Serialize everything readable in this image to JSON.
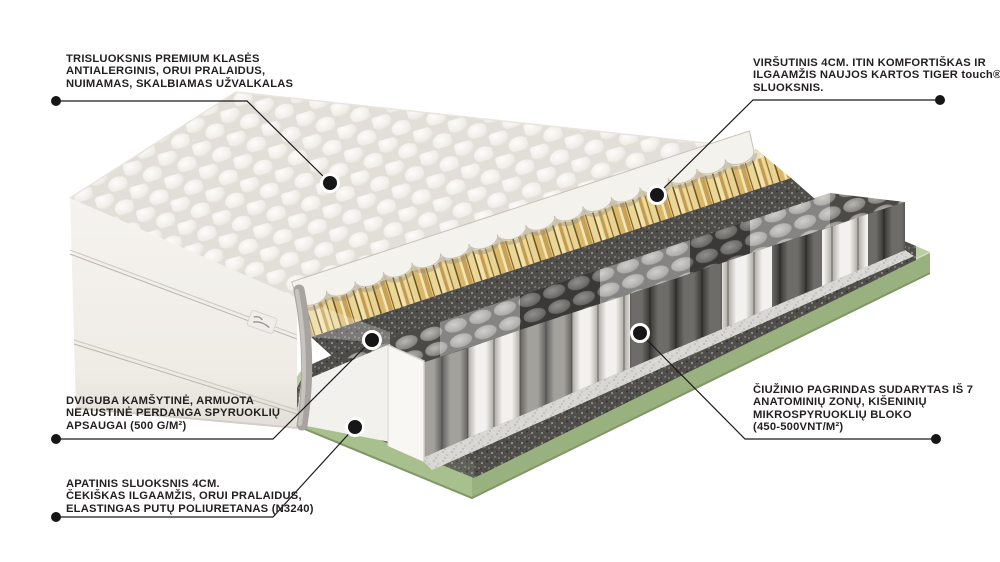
{
  "canvas": {
    "width": 1000,
    "height": 562,
    "background": "#ffffff"
  },
  "annotations": [
    {
      "id": "cover",
      "lines": [
        "TRISLUOKSNIS PREMIUM KLASĖS",
        "ANTIALERGINIS, ORUI PRALAIDUS,",
        "NUIMAMAS, SKALBIAMAS UŽVALKALAS"
      ]
    },
    {
      "id": "tiger-touch-layer",
      "lines": [
        "VIRŠUTINIS 4CM. ITIN KOMFORTIŠKAS IR",
        "ILGAAMŽIS NAUJOS KARTOS TIGER touch®",
        "SLUOKSNIS."
      ]
    },
    {
      "id": "spring-protect-felt",
      "lines": [
        "DVIGUBA KAMŠYTINĖ, ARMUOTA",
        "NEAUSTINĖ PERDANGA SPYRUOKLIŲ",
        "APSAUGAI (500 G/M²)"
      ]
    },
    {
      "id": "bottom-foam-layer",
      "lines": [
        "APATINIS SLUOKSNIS 4CM.",
        "ČEKIŠKAS ILGAAMŽIS, ORUI PRALAIDUS,",
        "ELASTINGAS PUTŲ POLIURETANAS (N3240)"
      ]
    },
    {
      "id": "micro-springs-core",
      "lines": [
        "ČIUŽINIO PAGRINDAS SUDARYTAS IŠ 7",
        "ANATOMINIŲ ZONŲ, KIŠENINIŲ",
        "MIKROSPYRUOKLIŲ BLOKO",
        "(450-500VNT/M²)"
      ]
    }
  ],
  "colors": {
    "text": "#231f20",
    "leader_line": "#1a1a1a",
    "quilt_white": "#f1efe9",
    "tiger_layer_yellow": "#e3cc86",
    "felt_gray": "#504e4b",
    "spring_white": "#f2f1ed",
    "spring_gray": "#a3a19c",
    "spring_dark": "#6e6c68",
    "base_foam_green": "#a8c08e"
  }
}
